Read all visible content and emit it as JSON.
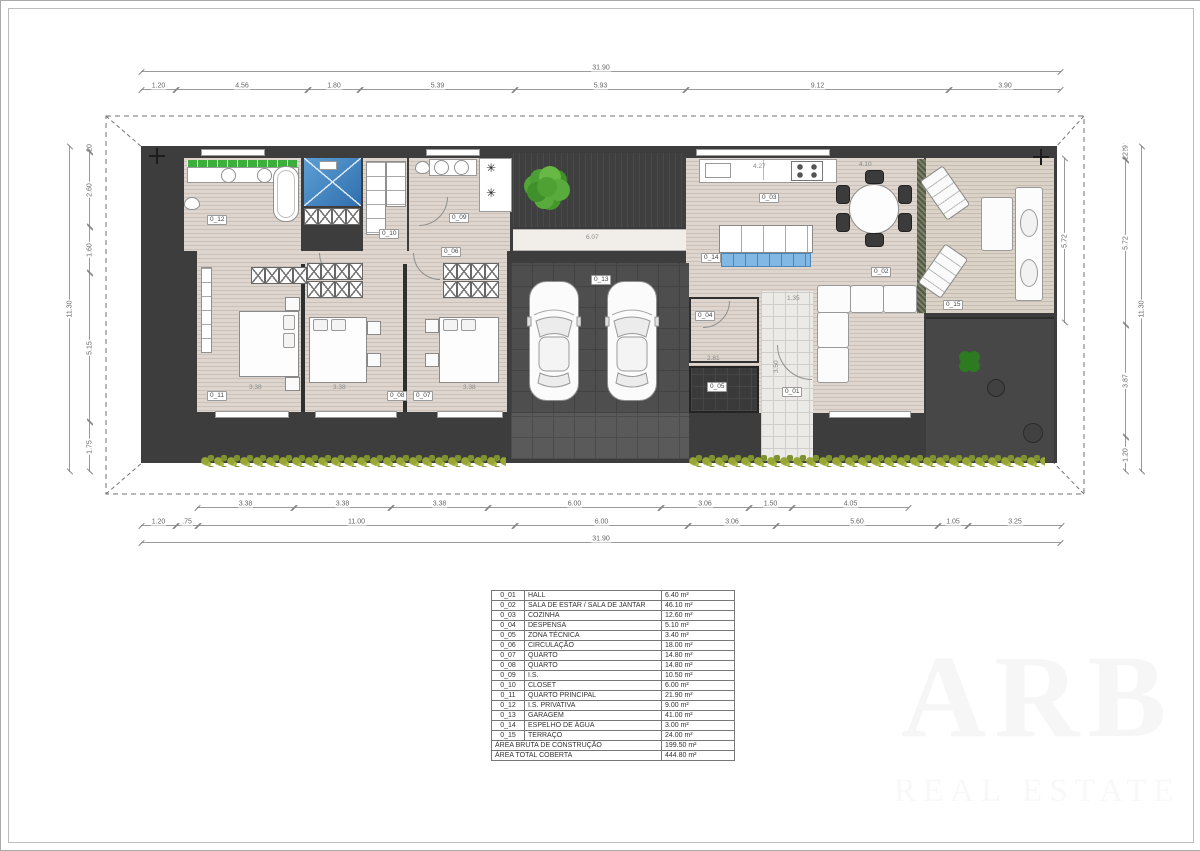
{
  "sheet": {
    "watermark_line1": "ARB",
    "watermark_line2": "REAL ESTATE"
  },
  "dimensions": {
    "top_total": "31.90",
    "top_segments": [
      "1.20",
      "4.56",
      "1.80",
      "5.39",
      "5.93",
      "9.12",
      "3.90"
    ],
    "bottom_row1": [
      "3.38",
      "3.38",
      "3.38",
      "6.00",
      "3.06",
      "1.50",
      "4.05"
    ],
    "bottom_row2": [
      "1.20",
      ".75",
      "11.00",
      "6.00",
      "3.06",
      "5.60",
      "1.05",
      "3.25"
    ],
    "bottom_total": "31.90",
    "left_segments": [
      ".20",
      "2.60",
      "1.60",
      "5.15",
      "1.75"
    ],
    "left_total": "11.30",
    "right_inner": [
      "5.72"
    ],
    "right_outer": [
      ".29",
      ".22",
      "5.72",
      "3.87",
      "1.20"
    ],
    "right_total": "11.30"
  },
  "interior_dims": [
    {
      "text": "6.07",
      "x": 585,
      "y": 233
    },
    {
      "text": "4.27",
      "x": 752,
      "y": 162
    },
    {
      "text": "4.10",
      "x": 858,
      "y": 160
    },
    {
      "text": "3.38",
      "x": 248,
      "y": 383
    },
    {
      "text": "3.38",
      "x": 332,
      "y": 383
    },
    {
      "text": "3.38",
      "x": 462,
      "y": 383
    },
    {
      "text": "1.35",
      "x": 786,
      "y": 294
    },
    {
      "text": "2.81",
      "x": 706,
      "y": 354
    },
    {
      "text": "3.50",
      "x": 772,
      "y": 372,
      "vert": true
    }
  ],
  "plan_labels": [
    {
      "code": "0_12",
      "x": 206,
      "y": 214
    },
    {
      "code": "0_10",
      "x": 378,
      "y": 228
    },
    {
      "code": "0_09",
      "x": 448,
      "y": 212
    },
    {
      "code": "0_06",
      "x": 440,
      "y": 246
    },
    {
      "code": "0_14",
      "x": 700,
      "y": 252
    },
    {
      "code": "0_03",
      "x": 758,
      "y": 192
    },
    {
      "code": "0_02",
      "x": 870,
      "y": 266
    },
    {
      "code": "0_15",
      "x": 942,
      "y": 299
    },
    {
      "code": "0_13",
      "x": 590,
      "y": 274
    },
    {
      "code": "0_04",
      "x": 694,
      "y": 310
    },
    {
      "code": "0_05",
      "x": 706,
      "y": 381
    },
    {
      "code": "0_01",
      "x": 781,
      "y": 386
    },
    {
      "code": "0_11",
      "x": 206,
      "y": 390
    },
    {
      "code": "0_08",
      "x": 386,
      "y": 390
    },
    {
      "code": "0_07",
      "x": 412,
      "y": 390
    }
  ],
  "areas_table": {
    "rows": [
      [
        "0_01",
        "HALL",
        "6.40 m²"
      ],
      [
        "0_02",
        "SALA DE ESTAR / SALA DE JANTAR",
        "46.10 m²"
      ],
      [
        "0_03",
        "COZINHA",
        "12.60 m²"
      ],
      [
        "0_04",
        "DESPENSA",
        "5.10 m²"
      ],
      [
        "0_05",
        "ZONA TÉCNICA",
        "3.40 m²"
      ],
      [
        "0_06",
        "CIRCULAÇÃO",
        "18.00 m²"
      ],
      [
        "0_07",
        "QUARTO",
        "14.80 m²"
      ],
      [
        "0_08",
        "QUARTO",
        "14.80 m²"
      ],
      [
        "0_09",
        "I.S.",
        "10.50 m²"
      ],
      [
        "0_10",
        "CLOSET",
        "6.00 m²"
      ],
      [
        "0_11",
        "QUARTO PRINCIPAL",
        "21.90 m²"
      ],
      [
        "0_12",
        "I.S. PRIVATIVA",
        "9.00 m²"
      ],
      [
        "0_13",
        "GARAGEM",
        "41.00 m²"
      ],
      [
        "0_14",
        "ESPELHO DE ÁGUA",
        "3.00 m²"
      ],
      [
        "0_15",
        "TERRAÇO",
        "24.00 m²"
      ]
    ],
    "totals": [
      [
        "ÁREA BRUTA DE CONSTRUÇÃO",
        "199.50 m²"
      ],
      [
        "ÁREA TOTAL COBERTA",
        "444.80 m²"
      ]
    ]
  }
}
